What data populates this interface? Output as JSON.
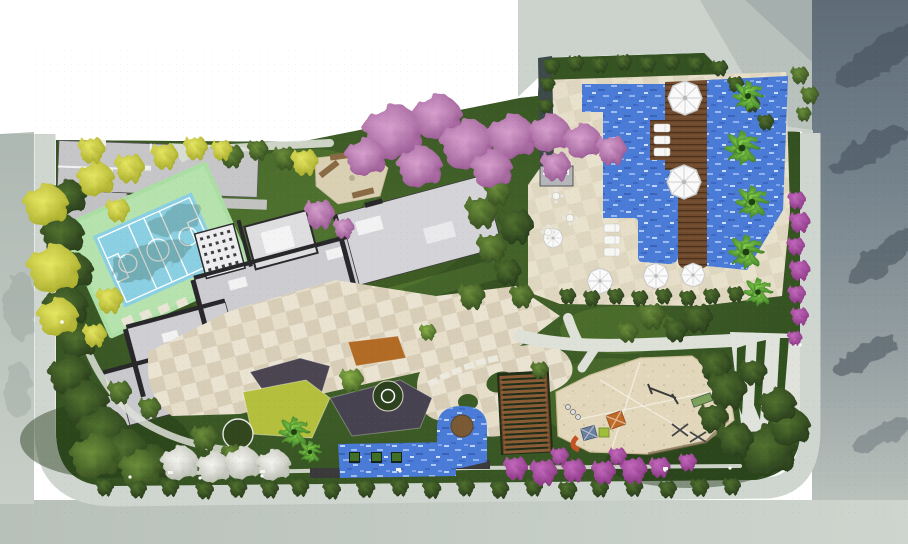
{
  "meta": {
    "view": "top-down architectural site plan rendering",
    "site": "residential condominium grounds with pool, sport court and playground"
  },
  "palette": {
    "background": "#ffffff",
    "street_left": "#b6bfb8",
    "street_bottom": "#c3ccc5",
    "street_right_dark": "#6b7884",
    "street_shadow": "#3f4b57",
    "sidewalk": "#cfd6cf",
    "neighbor_paving": "#ccd3cc",
    "curb": "#9aa49e",
    "lawn": "#3f6128",
    "lawn_light": "#5b8034",
    "hedge": "#24381c",
    "court_base": "#abdea2",
    "court_floor": "#8bd0e2",
    "court_lines": "#ffffff",
    "building_roof": "#cdcdd1",
    "building_roof_light": "#e2e2e4",
    "building_joint": "#28282a",
    "pool_water": "#4a7bd6",
    "pool_sparkle": "#a9c7f7",
    "deck_wood": "#6f4a2c",
    "paving_beige": "#e6dec8",
    "sand": "#e2d7ba",
    "bench_wood": "#8a6a44",
    "pergola_wood": "#8a5c36",
    "tree_yellow": "#d7d84b",
    "tree_pink": "#c387bd",
    "bougainvillea": "#b34fae",
    "tree_white": "#e9eae5",
    "palm_green": "#6cc043",
    "flower_orange": "#b26b25",
    "bed_dark": "#4a4550",
    "bed_yellow": "#b5bf3e",
    "play_orange": "#c06a28",
    "play_blue": "#6a7f9e",
    "play_green": "#9fbf3a",
    "slide_orange": "#c25427",
    "umbrella": "#fafafa",
    "furniture_white": "#f7f7f5",
    "planter_brown": "#7a5a35",
    "wall_dark": "#3e4a4a"
  },
  "features": [
    {
      "name": "sports-court",
      "label": "multi-sport court"
    },
    {
      "name": "main-building",
      "label": "residential building roof plan"
    },
    {
      "name": "neighbor-building",
      "label": "adjacent building roof"
    },
    {
      "name": "swimming-pool",
      "label": "pool with timber deck and umbrellas"
    },
    {
      "name": "pool-terrace",
      "label": "pool sun terrace"
    },
    {
      "name": "playground",
      "label": "children sand playground"
    },
    {
      "name": "pergola",
      "label": "timber pergola deck"
    },
    {
      "name": "water-feature",
      "label": "ornamental pools"
    },
    {
      "name": "seating-nook",
      "label": "garden bench corner"
    },
    {
      "name": "streets",
      "label": "surrounding streets and sidewalks"
    }
  ]
}
